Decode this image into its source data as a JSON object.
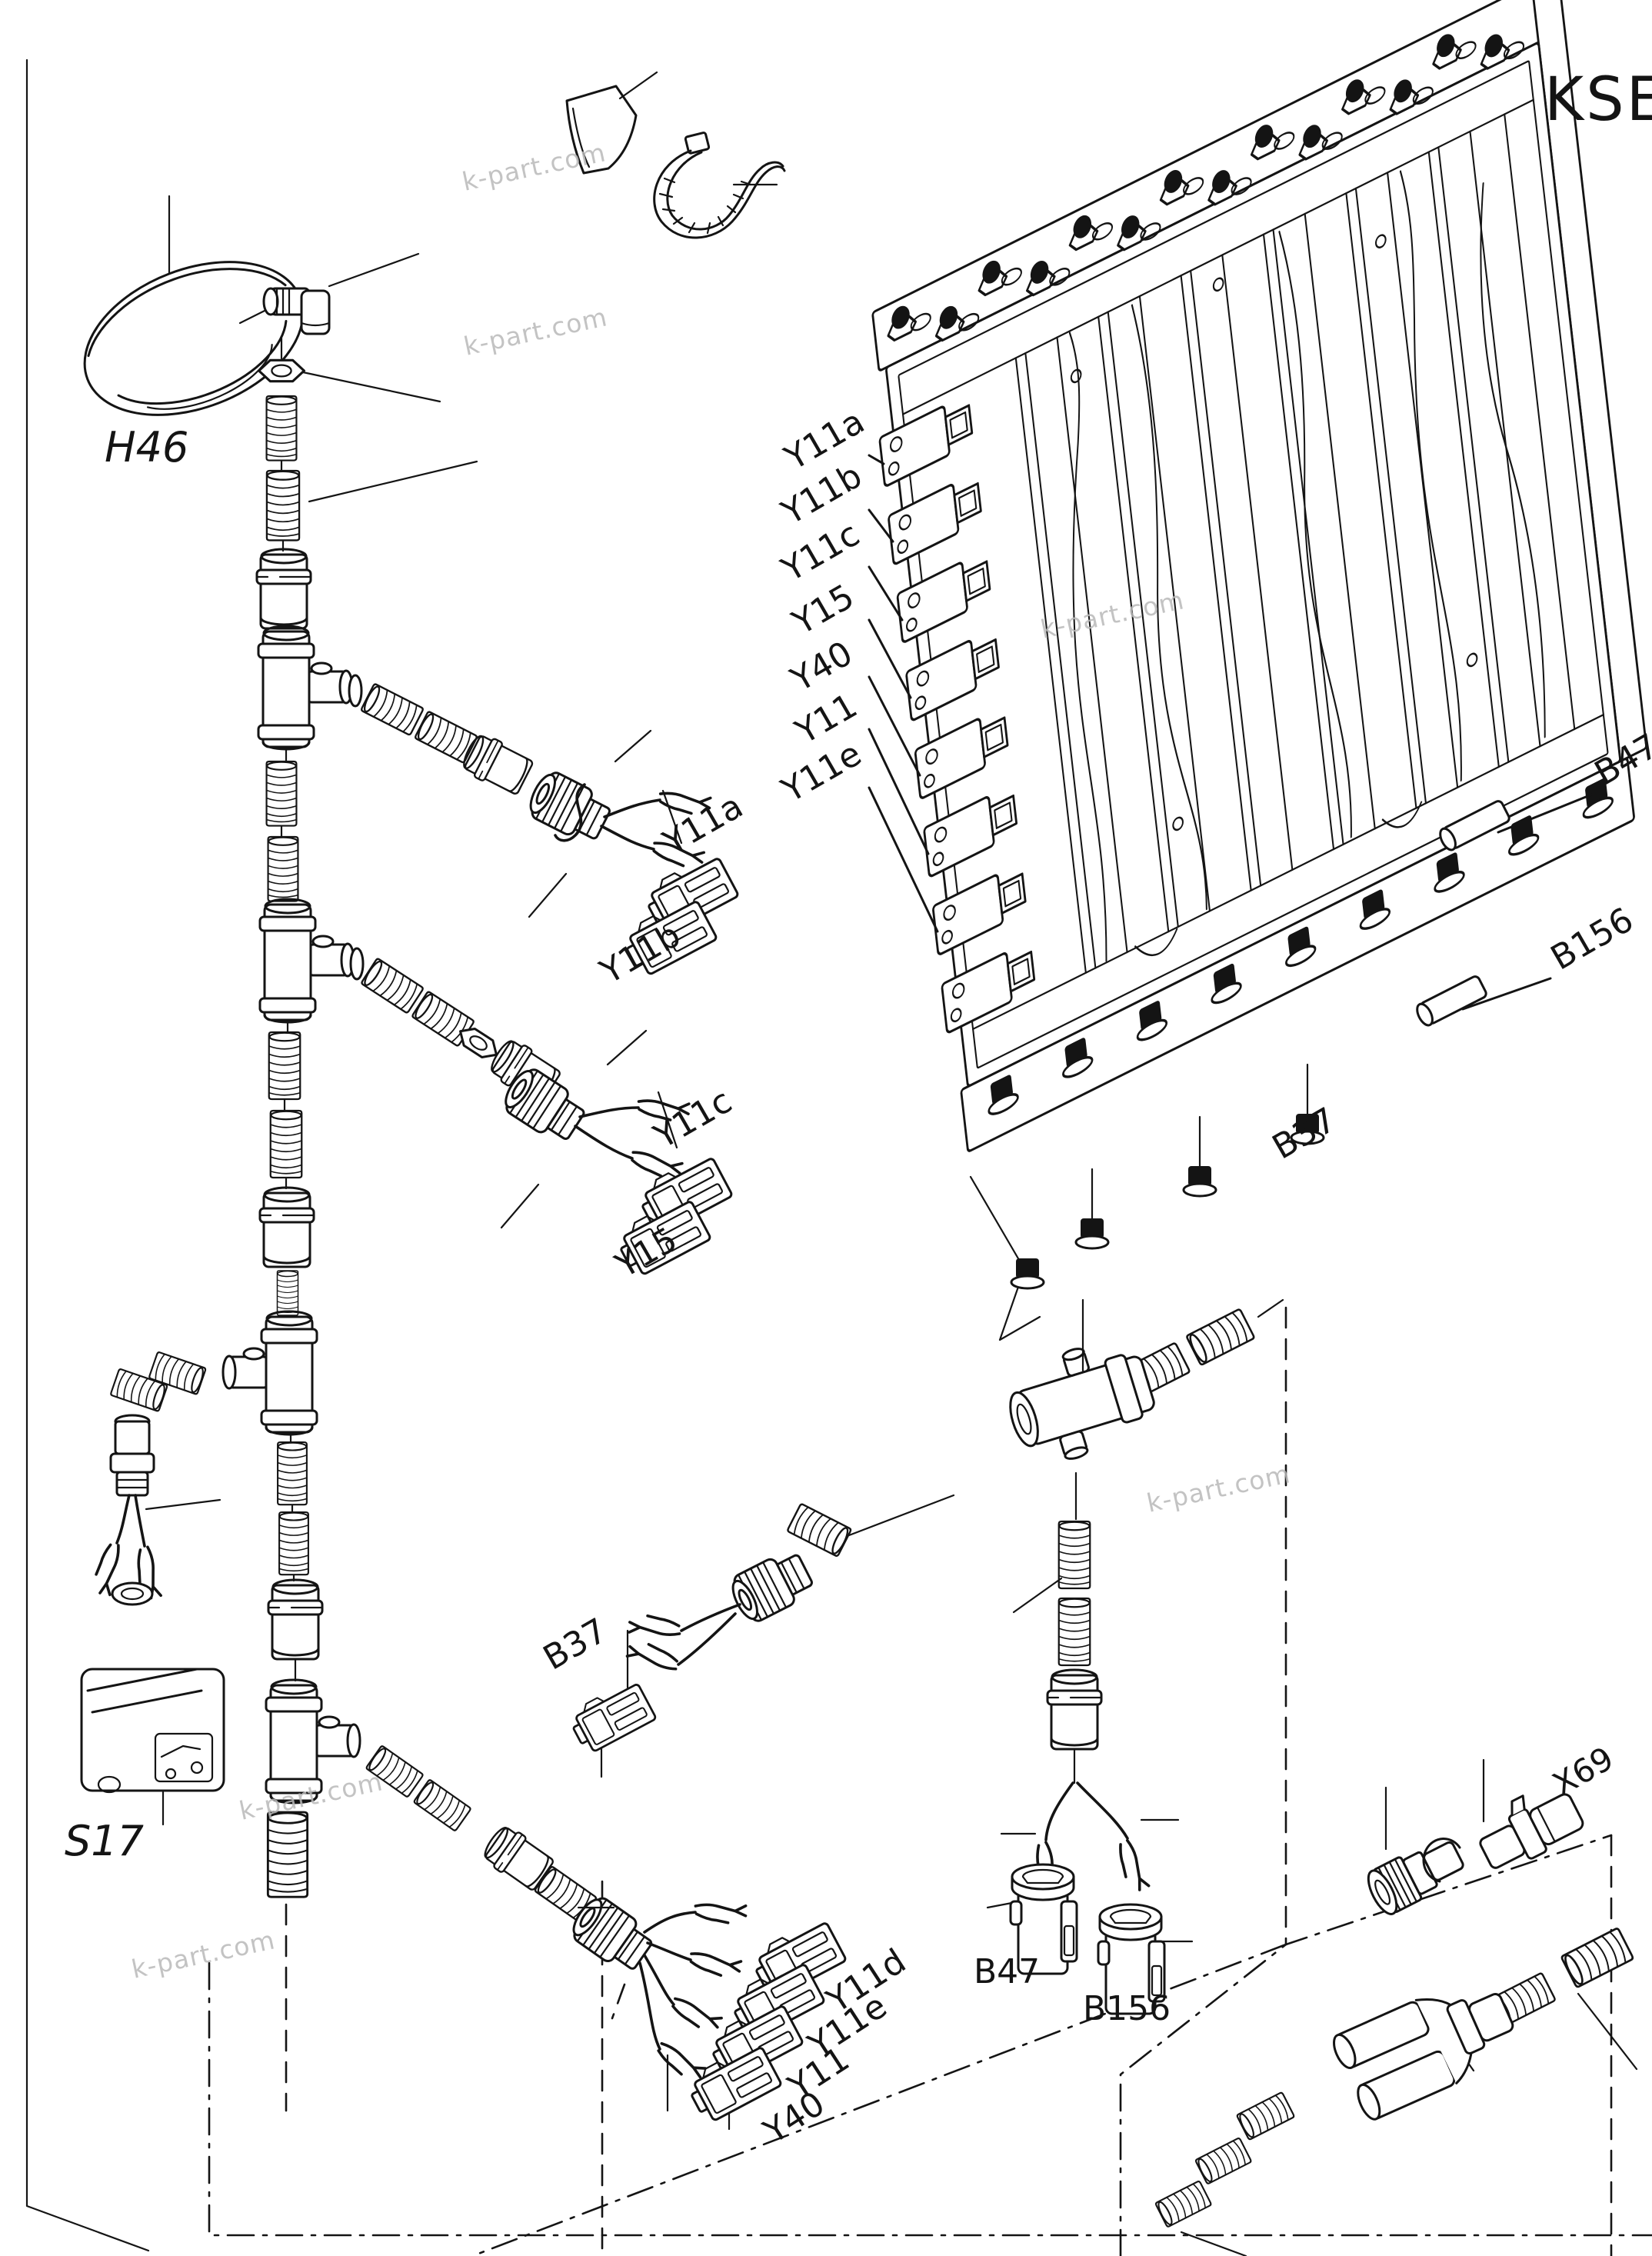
{
  "page": {
    "title_code": "KSE",
    "watermark": "k-part.com",
    "background": "#ffffff",
    "line_color": "#141414",
    "watermark_color": "#b9b9b9"
  },
  "labels": {
    "horn": "H46",
    "switch": "S17",
    "x69": "X69",
    "b37_cable": "B37",
    "plug_b47": "B47",
    "plug_b156": "B156",
    "valve_block": {
      "port_labels": [
        "Y11a",
        "Y11b",
        "Y11c",
        "Y15",
        "Y40",
        "Y11",
        "Y11e"
      ],
      "side_b47": "B47",
      "side_b156": "B156",
      "bottom_b37": "B37"
    },
    "branch1": [
      "Y11a",
      "Y11b"
    ],
    "branch2": [
      "Y11c",
      "Y15"
    ],
    "bran3_note": "",
    "branch3": [
      "Y11d",
      "Y11e",
      "Y11",
      "Y40"
    ]
  }
}
